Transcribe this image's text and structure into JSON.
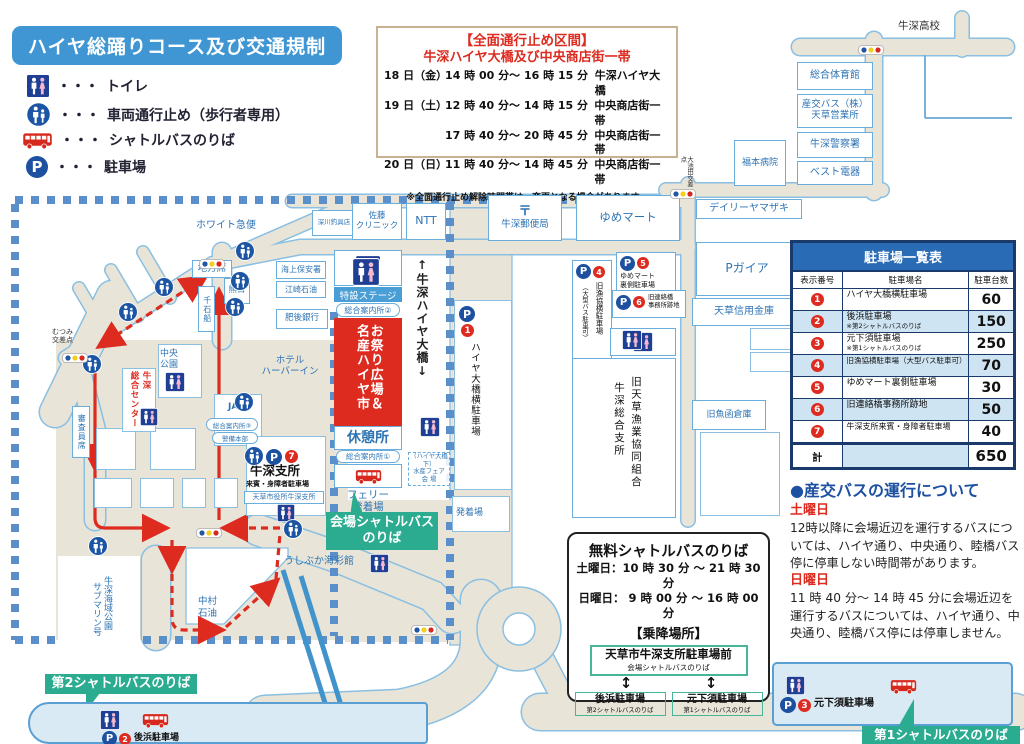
{
  "colors": {
    "accent_blue": "#3f96d2",
    "navy": "#1d50a0",
    "red": "#dd2b20",
    "teal": "#2bab8f",
    "road": "#e8e4d8",
    "road_border": "#8abfe2",
    "dash_border": "#5b8fc9",
    "table_header": "#2a6bb5",
    "row_alt": "#cfe4f3",
    "label_blue": "#2e74b5",
    "inset_bg": "#d9eaf4"
  },
  "legend": {
    "title": "ハイヤ総踊りコース及び交通規制",
    "dots": "・・・",
    "items": [
      {
        "icon": "toilet-icon",
        "label": "トイレ"
      },
      {
        "icon": "pedestrian-only-icon",
        "label": "車両通行止め（歩行者専用）"
      },
      {
        "icon": "shuttle-bus-icon",
        "label": "シャトルバスのりば"
      },
      {
        "icon": "parking-icon",
        "label": "駐車場"
      }
    ]
  },
  "notice": {
    "title": "【全面通行止め区間】",
    "subtitle": "牛深ハイヤ大橋及び中央商店街一帯",
    "rows": [
      {
        "day": "18 日（金）",
        "time": "14 時 00 分～ 16 時 15 分",
        "place": "牛深ハイヤ大橋"
      },
      {
        "day": "19 日（土）",
        "time": "12 時 40 分～ 14 時 15 分",
        "place": "中央商店街一帯"
      },
      {
        "day": "",
        "time": "17 時 40 分～ 20 時 45 分",
        "place": "中央商店街一帯"
      },
      {
        "day": "20 日（日）",
        "time": "11 時 40 分～ 14 時 45 分",
        "place": "中央商店街一帯"
      }
    ],
    "note": "※全面通行止め解除時間帯は、変更となる場合があります。"
  },
  "parking_table": {
    "title": "駐車場一覧表",
    "headers": [
      "表示番号",
      "駐車場名",
      "駐車台数"
    ],
    "rows": [
      {
        "no": "1",
        "name": "ハイヤ大橋横駐車場",
        "note": "",
        "capacity": "60"
      },
      {
        "no": "2",
        "name": "後浜駐車場",
        "note": "※第2シャトルバスのりば",
        "capacity": "150"
      },
      {
        "no": "3",
        "name": "元下須駐車場",
        "note": "※第1シャトルバスのりば",
        "capacity": "250"
      },
      {
        "no": "4",
        "name": "旧漁協横駐車場（大型バス駐車可）",
        "note": "",
        "capacity": "70"
      },
      {
        "no": "5",
        "name": "ゆめマート裏側駐車場",
        "note": "",
        "capacity": "30"
      },
      {
        "no": "6",
        "name": "旧連絡橋事務所跡地",
        "note": "",
        "capacity": "50"
      },
      {
        "no": "7",
        "name": "牛深支所来賓・身障者駐車場",
        "note": "",
        "capacity": "40"
      }
    ],
    "total_label": "計",
    "total": "650"
  },
  "bus_info": {
    "heading": "●産交バスの運行について",
    "saturday_label": "土曜日",
    "saturday_text": "12時以降に会場近辺を運行するバスについては、ハイヤ通り、中央通り、睦橋バス停に停車しない時間帯があります。",
    "sunday_label": "日曜日",
    "sunday_text": "11 時 40 分～ 14 時 45 分に会場近辺を運行するバスについては、ハイヤ通り、中央通り、睦橋バス停には停車しません。"
  },
  "shuttle_box": {
    "title": "無料シャトルバスのりば",
    "saturday": "土曜日：10 時 30 分 ～ 21 時 30 分",
    "sunday": "日曜日： 9 時 00 分 ～ 16 時 00 分",
    "section": "【乗降場所】",
    "arrow": "↕",
    "main_stop": {
      "name": "天草市牛深支所駐車場前",
      "sub": "会場シャトルバスのりば"
    },
    "stops": [
      {
        "name": "後浜駐車場",
        "sub": "第2シャトルバスのりば"
      },
      {
        "name": "元下須駐車場",
        "sub": "第1シャトルバスのりば"
      }
    ]
  },
  "map": {
    "p": "P",
    "numbers": [
      "1",
      "2",
      "3",
      "4",
      "5",
      "6",
      "7"
    ],
    "labels": {
      "ushibuka_hs": "牛深高校",
      "taiikukan": "総合体育館",
      "sanko1": "産交バス（株）",
      "sanko2": "天草営業所",
      "police": "牛深警察署",
      "best": "ベスト電器",
      "fukumoto": "福本病院",
      "daily": "デイリーヤマザキ",
      "oikeda": "大池田交差点",
      "pgaia": "Pガイア",
      "shinkin": "天草信用金庫",
      "gyobako": "旧魚函倉庫",
      "white9": "ホワイト急便",
      "fukagawa": "深川釣具店",
      "sato1": "佐藤",
      "sato2": "クリニック",
      "ntt": "NTT",
      "postmark": "〒",
      "post": "牛深郵便局",
      "yume": "ゆめマート",
      "chiho": "地方席",
      "kumanichi": "熊日",
      "kaiho": "海上保安署",
      "ezaki": "江崎石油",
      "higo": "肥後銀行",
      "hotel1": "ホテル",
      "hotel2": "ハーバーイン",
      "mutsumi1": "むつみ",
      "mutsumi2": "交差点",
      "park1": "中央",
      "park2": "公園",
      "center_r": "牛深",
      "center_l": "総合センター",
      "shinsa": "審査員席",
      "sengoku": "千石船",
      "ja": "JA",
      "annai3": "総合案内所③",
      "keibi": "警備本部",
      "shisho": "牛深支所",
      "raihin": "来賓・身障者駐車場",
      "shiyakusho": "天草市役所牛深支所",
      "stage": "特設ステージ",
      "annai2": "総合案内所②",
      "matsuri": "お祭り広場＆名産ハイヤ市",
      "kyukei": "休憩所",
      "annai1": "総合案内所①",
      "ferry1": "フェリー",
      "ferry2": "発着場",
      "kaijo_shuttle1": "会場シャトルバス",
      "kaijo_shuttle2": "のりば",
      "bridge": "↑牛深ハイヤ大橋↓",
      "p1name": "ハイヤ大橋横駐車場",
      "suisan1": "（ハイヤ大橋下）",
      "suisan2": "水産フェア",
      "suisan3": "会 場",
      "hatchaku": "発着場",
      "p4name": "旧漁協横駐車場",
      "p4note": "（大型バス駐車可）",
      "p5name1": "ゆめマート",
      "p5name2": "裏側駐車場",
      "p6name1": "旧連絡橋",
      "p6name2": "事務所跡地",
      "gyokyo_r": "旧天草漁業協同組合",
      "gyokyo_l": "牛深総合支所",
      "submarine_r": "牛深海域公園",
      "submarine_l": "サブマリン号",
      "nakamura1": "中村",
      "nakamura2": "石油",
      "kaisaikan": "うしぶか海彩館",
      "shuttle2": "第2シャトルバスのりば",
      "gohama": "後浜駐車場",
      "shuttle1": "第1シャトルバスのりば",
      "motoshimosu": "元下須駐車場"
    }
  }
}
